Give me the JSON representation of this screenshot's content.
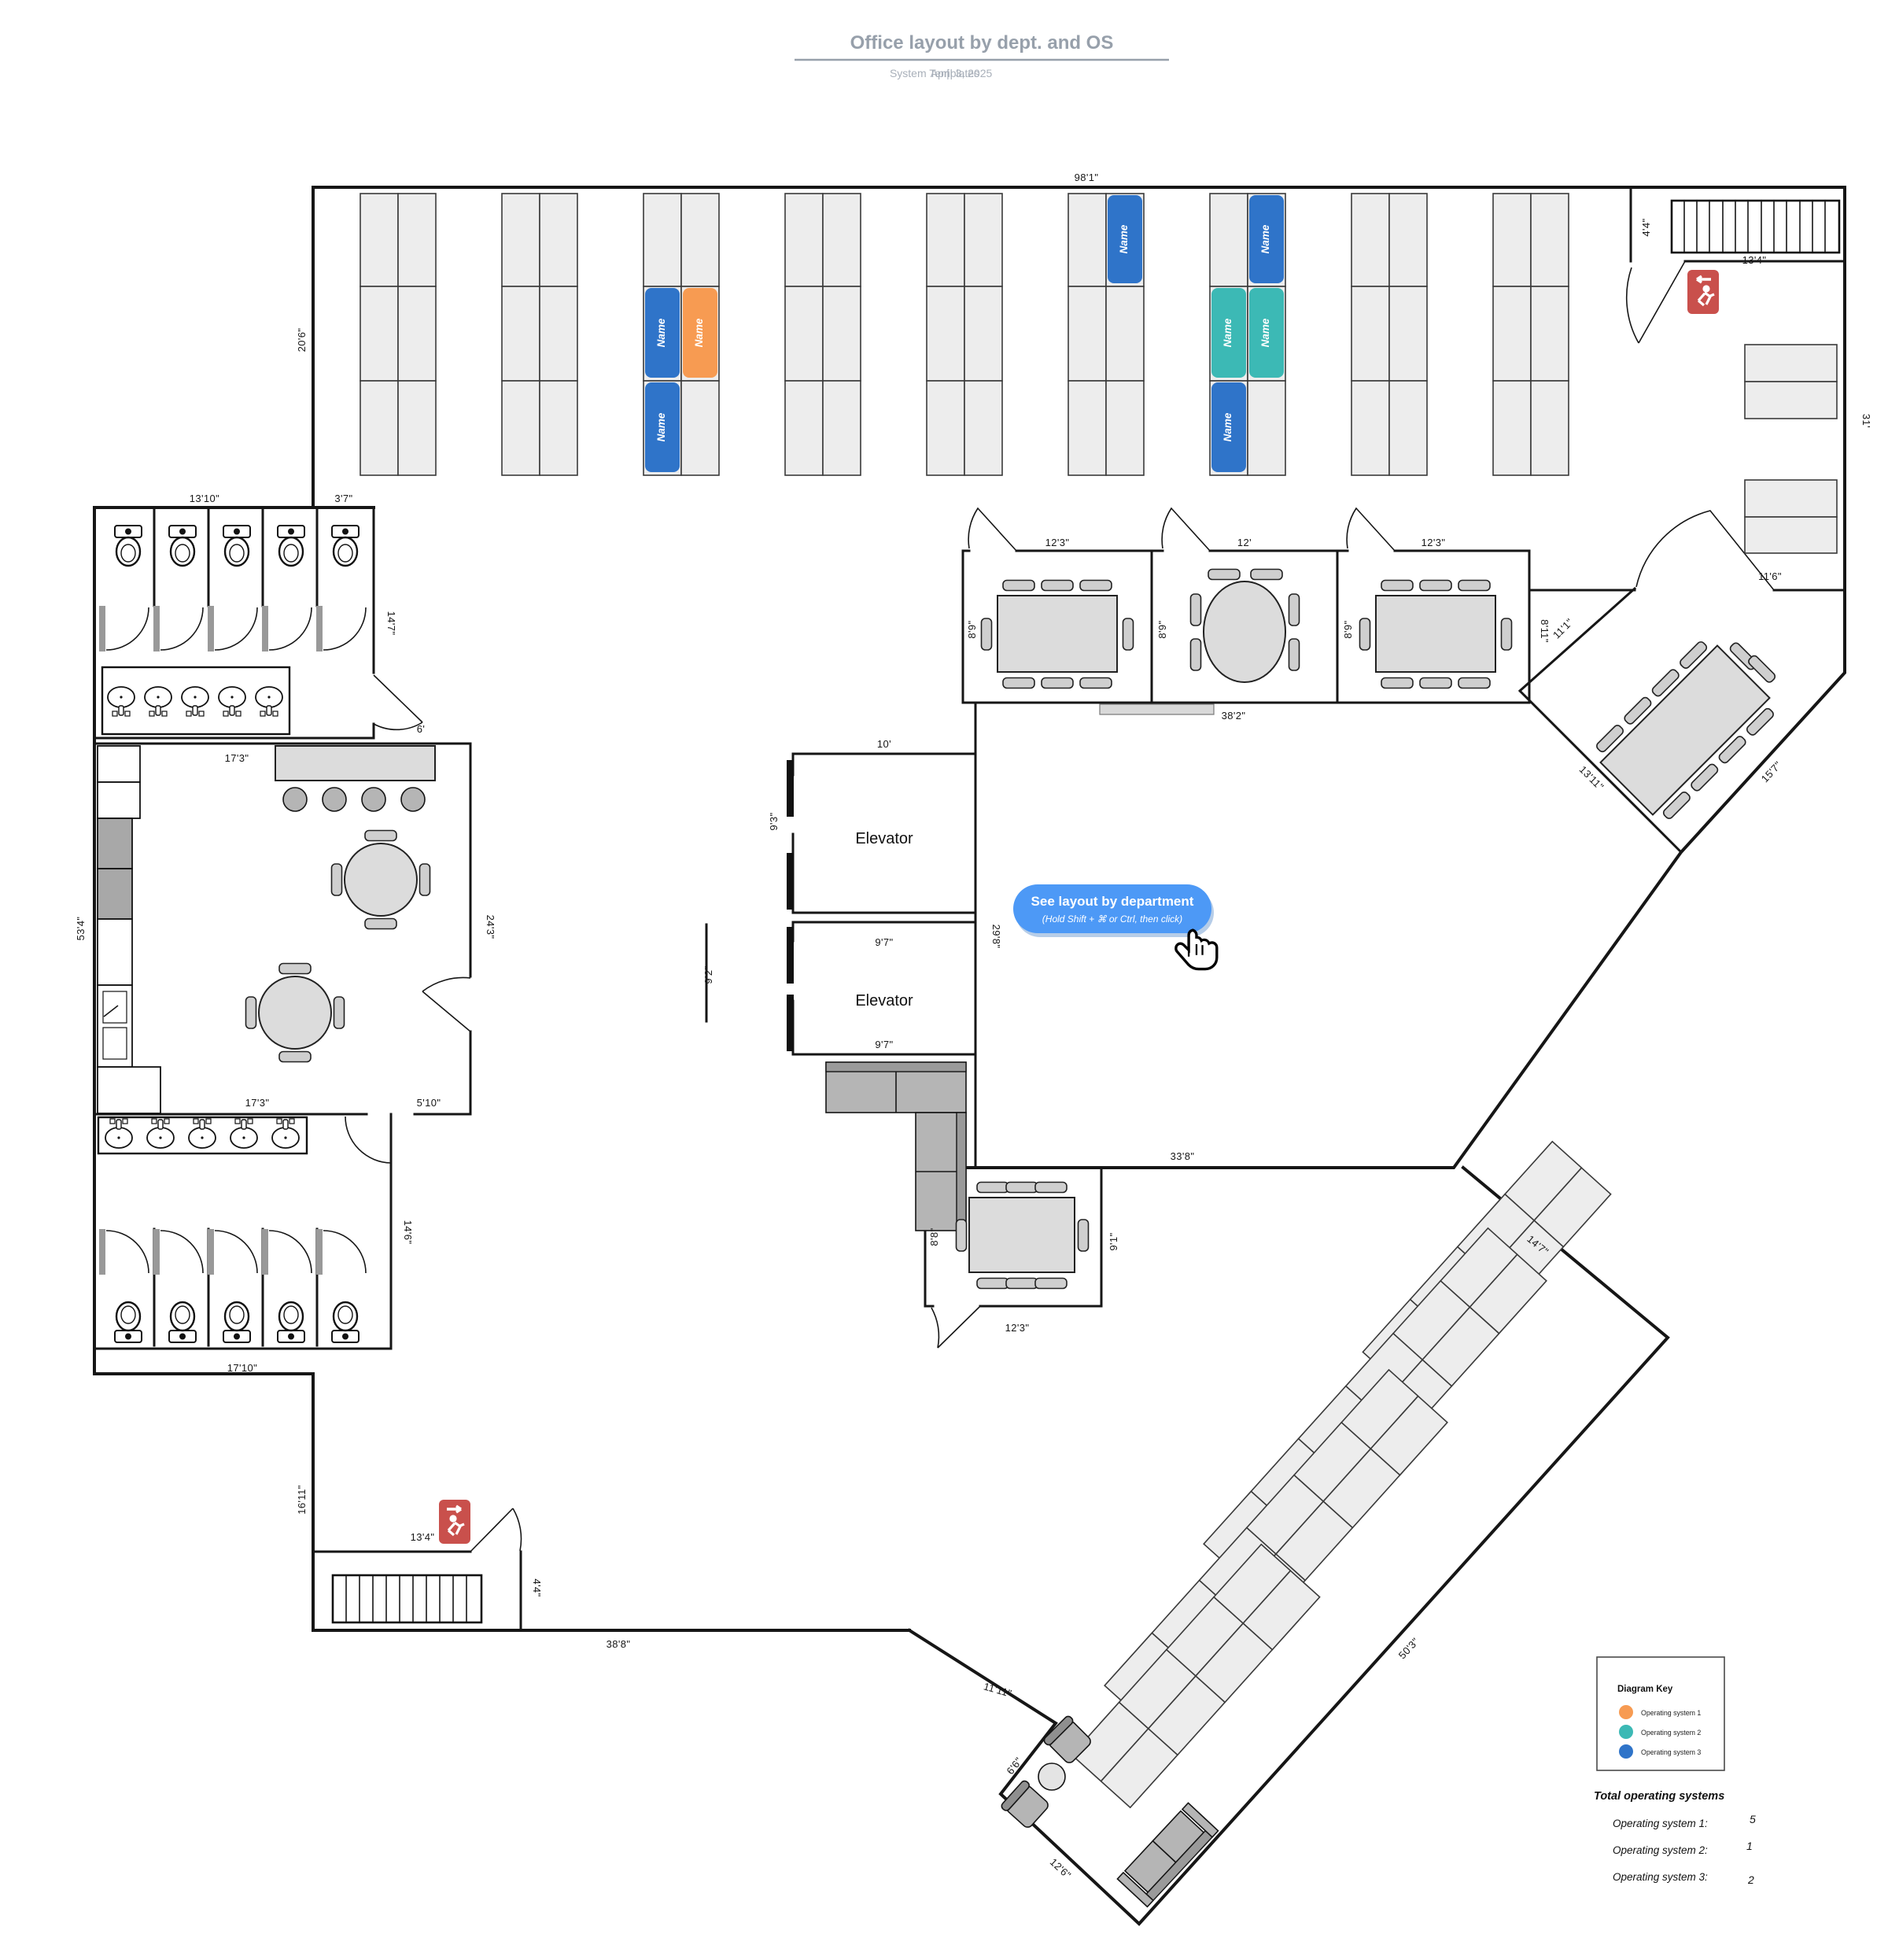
{
  "header": {
    "title": "Office layout by dept. and OS",
    "source": "System Templates",
    "separator": "|",
    "date": "April 3, 2025"
  },
  "callout": {
    "title": "See layout by department",
    "subtitle": "(Hold Shift + ⌘ or Ctrl, then click)"
  },
  "rooms": {
    "elevator_a": "Elevator",
    "elevator_b": "Elevator"
  },
  "desk_chip": {
    "text": "Name"
  },
  "colors": {
    "os1": "#F79B52",
    "os2": "#3CB9B5",
    "os3": "#2F74C9",
    "callout": "#4D99F6",
    "exit": "#C9504C"
  },
  "legend": {
    "title": "Diagram Key",
    "items": [
      {
        "label": "Operating system 1",
        "color": "#F79B52"
      },
      {
        "label": "Operating system 2",
        "color": "#3CB9B5"
      },
      {
        "label": "Operating system 3",
        "color": "#2F74C9"
      }
    ]
  },
  "totals": {
    "title": "Total operating systems",
    "rows": [
      {
        "label": "Operating system 1:",
        "value": "5"
      },
      {
        "label": "Operating system 2:",
        "value": "1"
      },
      {
        "label": "Operating system 3:",
        "value": "2"
      }
    ]
  },
  "dims": {
    "top98": "98'1\"",
    "left20_6": "20'6\"",
    "bath13_10": "13'10\"",
    "bath3_7": "3'7\"",
    "bath14_7": "14'7\"",
    "cor6": "6'",
    "kit17_3": "17'3\"",
    "left53_4": "53'4\"",
    "kit24_3": "24'3\"",
    "kit17_3b": "17'3\"",
    "kit5_10": "5'10\"",
    "bath14_6": "14'6\"",
    "bath17_10": "17'10\"",
    "bl16_11": "16'11\"",
    "bl13_4": "13'4\"",
    "bl4_4": "4'4\"",
    "bl38_8": "38'8\"",
    "wing11_11": "11'11\"",
    "wing6_6": "6'6\"",
    "wing12_6": "12'6\"",
    "wing50_3": "50'3\"",
    "wing14_7": "14'7\"",
    "mid33_8": "33'8\"",
    "br8_8": "8'8\"",
    "br9_1": "9'1\"",
    "br12_3": "12'3\"",
    "ra12_3": "12'3\"",
    "rb12": "12'",
    "rc12_3": "12'3\"",
    "ra8_9": "8'9\"",
    "rb8_9": "8'9\"",
    "rc8_9": "8'9\"",
    "rc8_11": "8'11\"",
    "band38_2": "38'2\"",
    "el10": "10'",
    "el9_3": "9'3\"",
    "el9_7a": "9'7\"",
    "el9_7b": "9'7\"",
    "el9_2": "9'2\"",
    "el29_8": "29'8\"",
    "tr31": "31'",
    "tr11_6": "11'6\"",
    "tr4_4": "4'4\"",
    "tr13_4": "13'4\"",
    "dm11_1": "11'1\"",
    "dm13_11": "13'11\"",
    "dm15_7": "15'7\""
  }
}
